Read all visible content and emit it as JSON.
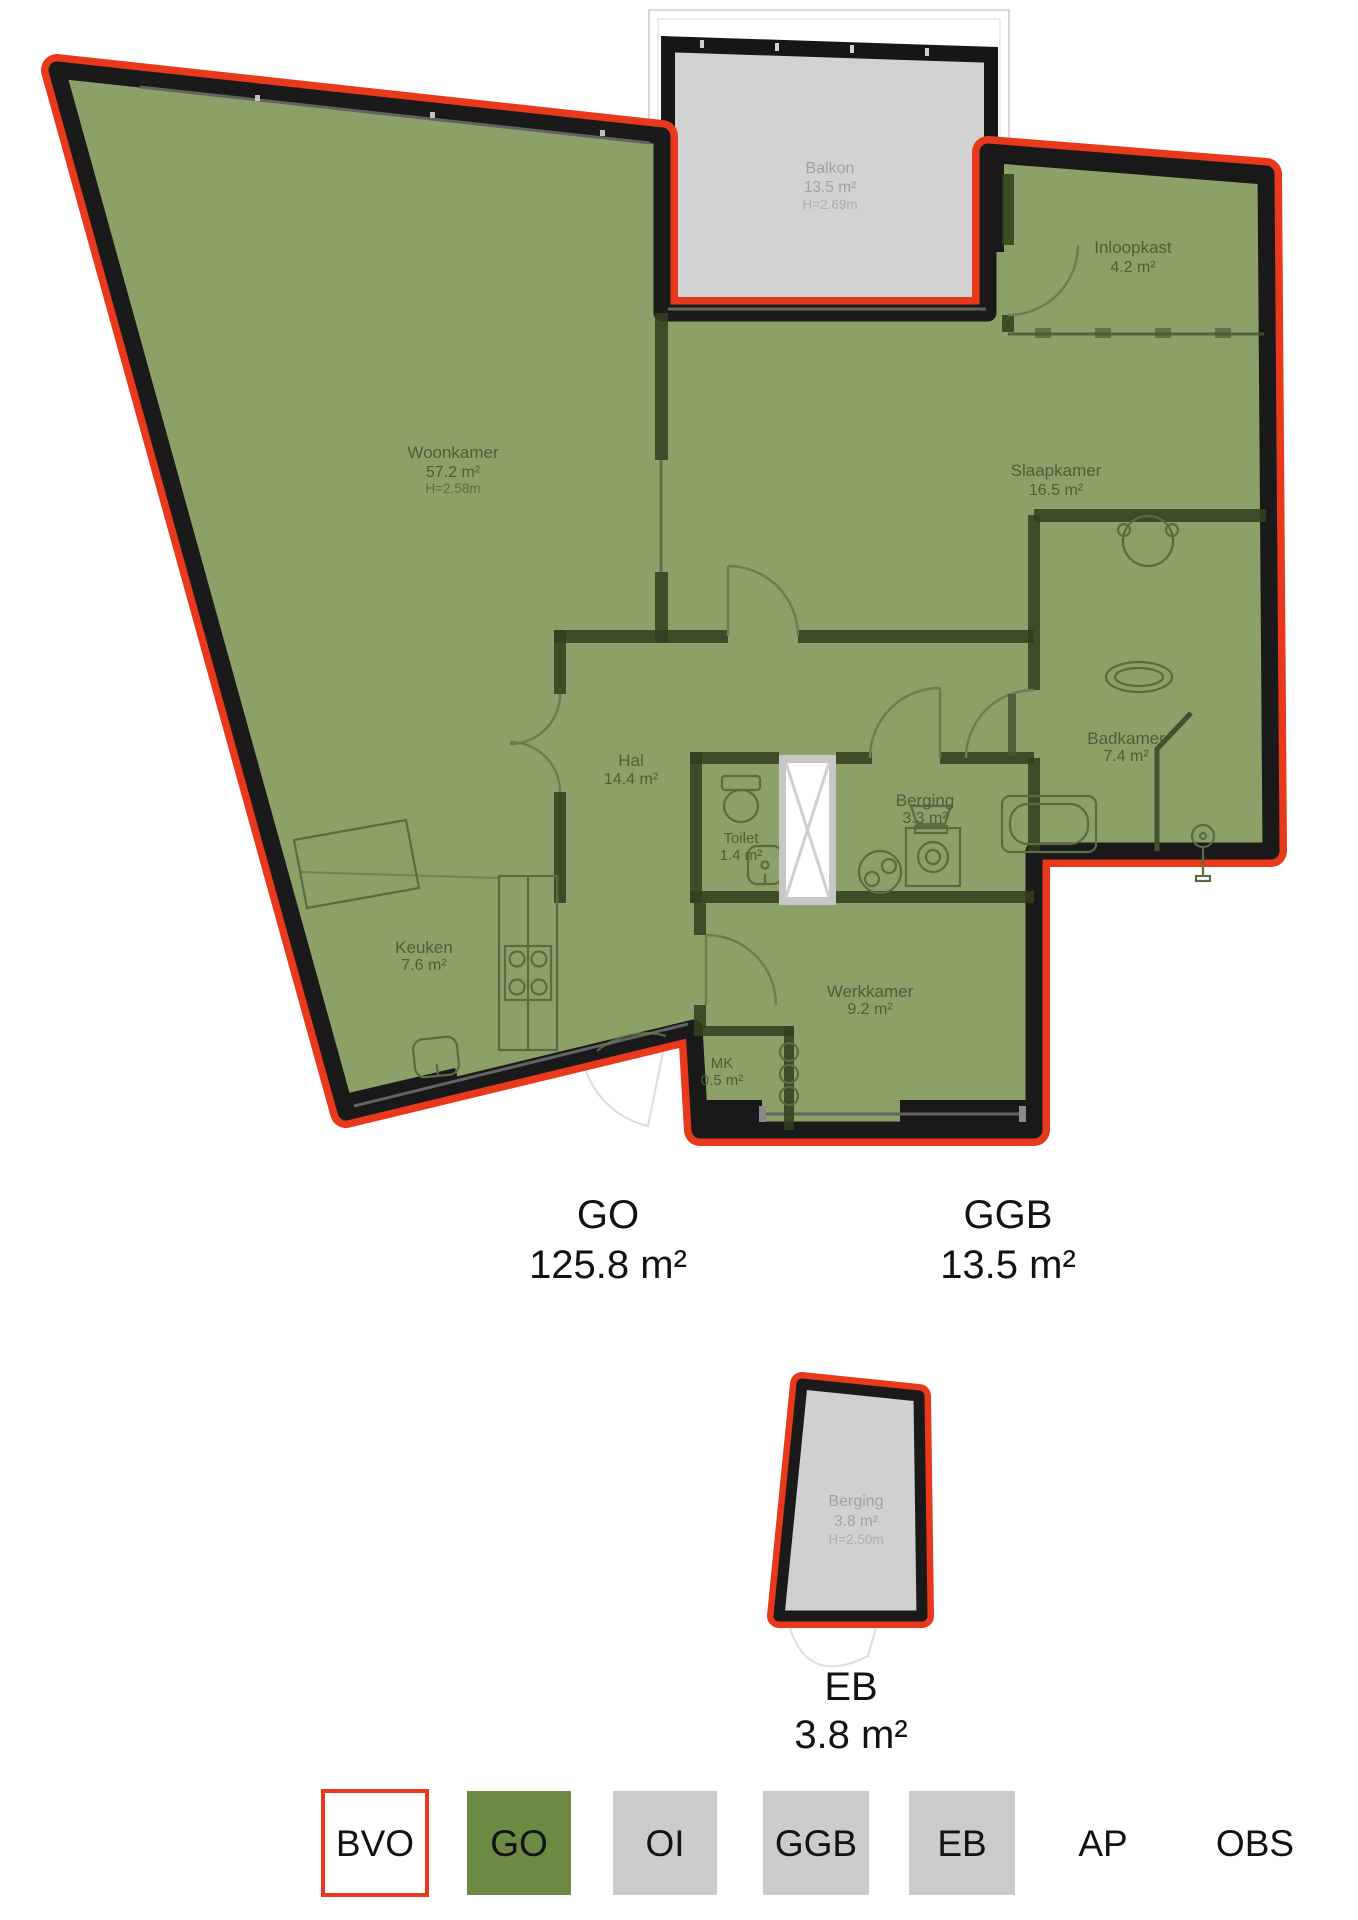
{
  "colors": {
    "bvo_outline_red": "#e8391c",
    "wall_black": "#1a1a1a",
    "go_green_plan": "#8ba168",
    "go_green_legend": "#6d8a45",
    "ggb_eb_grey": "#d2d2d2",
    "legend_grey": "#cbcbcb"
  },
  "plan": {
    "rooms": {
      "balkon": {
        "name": "Balkon",
        "area": "13.5 m²",
        "height": "H=2.69m"
      },
      "inloopkast": {
        "name": "Inloopkast",
        "area": "4.2 m²"
      },
      "woonkamer": {
        "name": "Woonkamer",
        "area": "57.2 m²",
        "height": "H=2.58m"
      },
      "slaapkamer": {
        "name": "Slaapkamer",
        "area": "16.5 m²"
      },
      "hal": {
        "name": "Hal",
        "area": "14.4 m²"
      },
      "toilet": {
        "name": "Toilet",
        "area": "1.4 m²"
      },
      "berging": {
        "name": "Berging",
        "area": "3.3 m²"
      },
      "badkamer": {
        "name": "Badkamer",
        "area": "7.4 m²"
      },
      "keuken": {
        "name": "Keuken",
        "area": "7.6 m²"
      },
      "werkkamer": {
        "name": "Werkkamer",
        "area": "9.2 m²"
      },
      "mk": {
        "name": "MK",
        "area": "0.5 m²"
      }
    }
  },
  "summary": {
    "go": {
      "label": "GO",
      "value": "125.8 m²"
    },
    "ggb": {
      "label": "GGB",
      "value": "13.5 m²"
    },
    "eb": {
      "label": "EB",
      "value": "3.8 m²"
    }
  },
  "external_storage": {
    "name": "Berging",
    "area": "3.8 m²",
    "height": "H=2.50m"
  },
  "legend": {
    "items": [
      {
        "label": "BVO",
        "style": "outlined-red"
      },
      {
        "label": "GO",
        "style": "green"
      },
      {
        "label": "OI",
        "style": "grey"
      },
      {
        "label": "GGB",
        "style": "grey"
      },
      {
        "label": "EB",
        "style": "grey"
      },
      {
        "label": "AP",
        "style": "text-only"
      },
      {
        "label": "OBS",
        "style": "text-only"
      }
    ]
  }
}
